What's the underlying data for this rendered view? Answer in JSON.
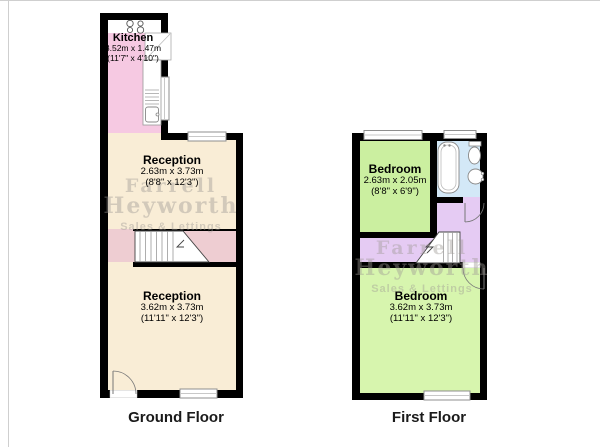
{
  "palette": {
    "kitchen": "#f6c9e2",
    "reception": "#f9edd6",
    "hall_stairs": "#eecdd2",
    "bedroom_small": "#cbefa0",
    "bedroom_large": "#d7f5ae",
    "bathroom": "#d3e8f7",
    "landing": "#e5cbf3",
    "wall": "#000000"
  },
  "ground_floor": {
    "caption": "Ground Floor",
    "rooms": [
      {
        "name": "Kitchen",
        "dims_metric": "3.52m x 1.47m",
        "dims_imperial": "(11'7\" x 4'10\")"
      },
      {
        "name": "Reception",
        "dims_metric": "2.63m x 3.73m",
        "dims_imperial": "(8'8\" x 12'3\")"
      },
      {
        "name": "Reception",
        "dims_metric": "3.62m x 3.73m",
        "dims_imperial": "(11'11\" x 12'3\")"
      }
    ]
  },
  "first_floor": {
    "caption": "First Floor",
    "rooms": [
      {
        "name": "Bedroom",
        "dims_metric": "2.63m x 2.05m",
        "dims_imperial": "(8'8\" x 6'9\")"
      },
      {
        "name": "Bedroom",
        "dims_metric": "3.62m x 3.73m",
        "dims_imperial": "(11'11\" x 12'3\")"
      }
    ]
  },
  "watermark": {
    "line1": "Farrell",
    "line2": "Heyworth",
    "line3": "Sales & Lettings"
  }
}
